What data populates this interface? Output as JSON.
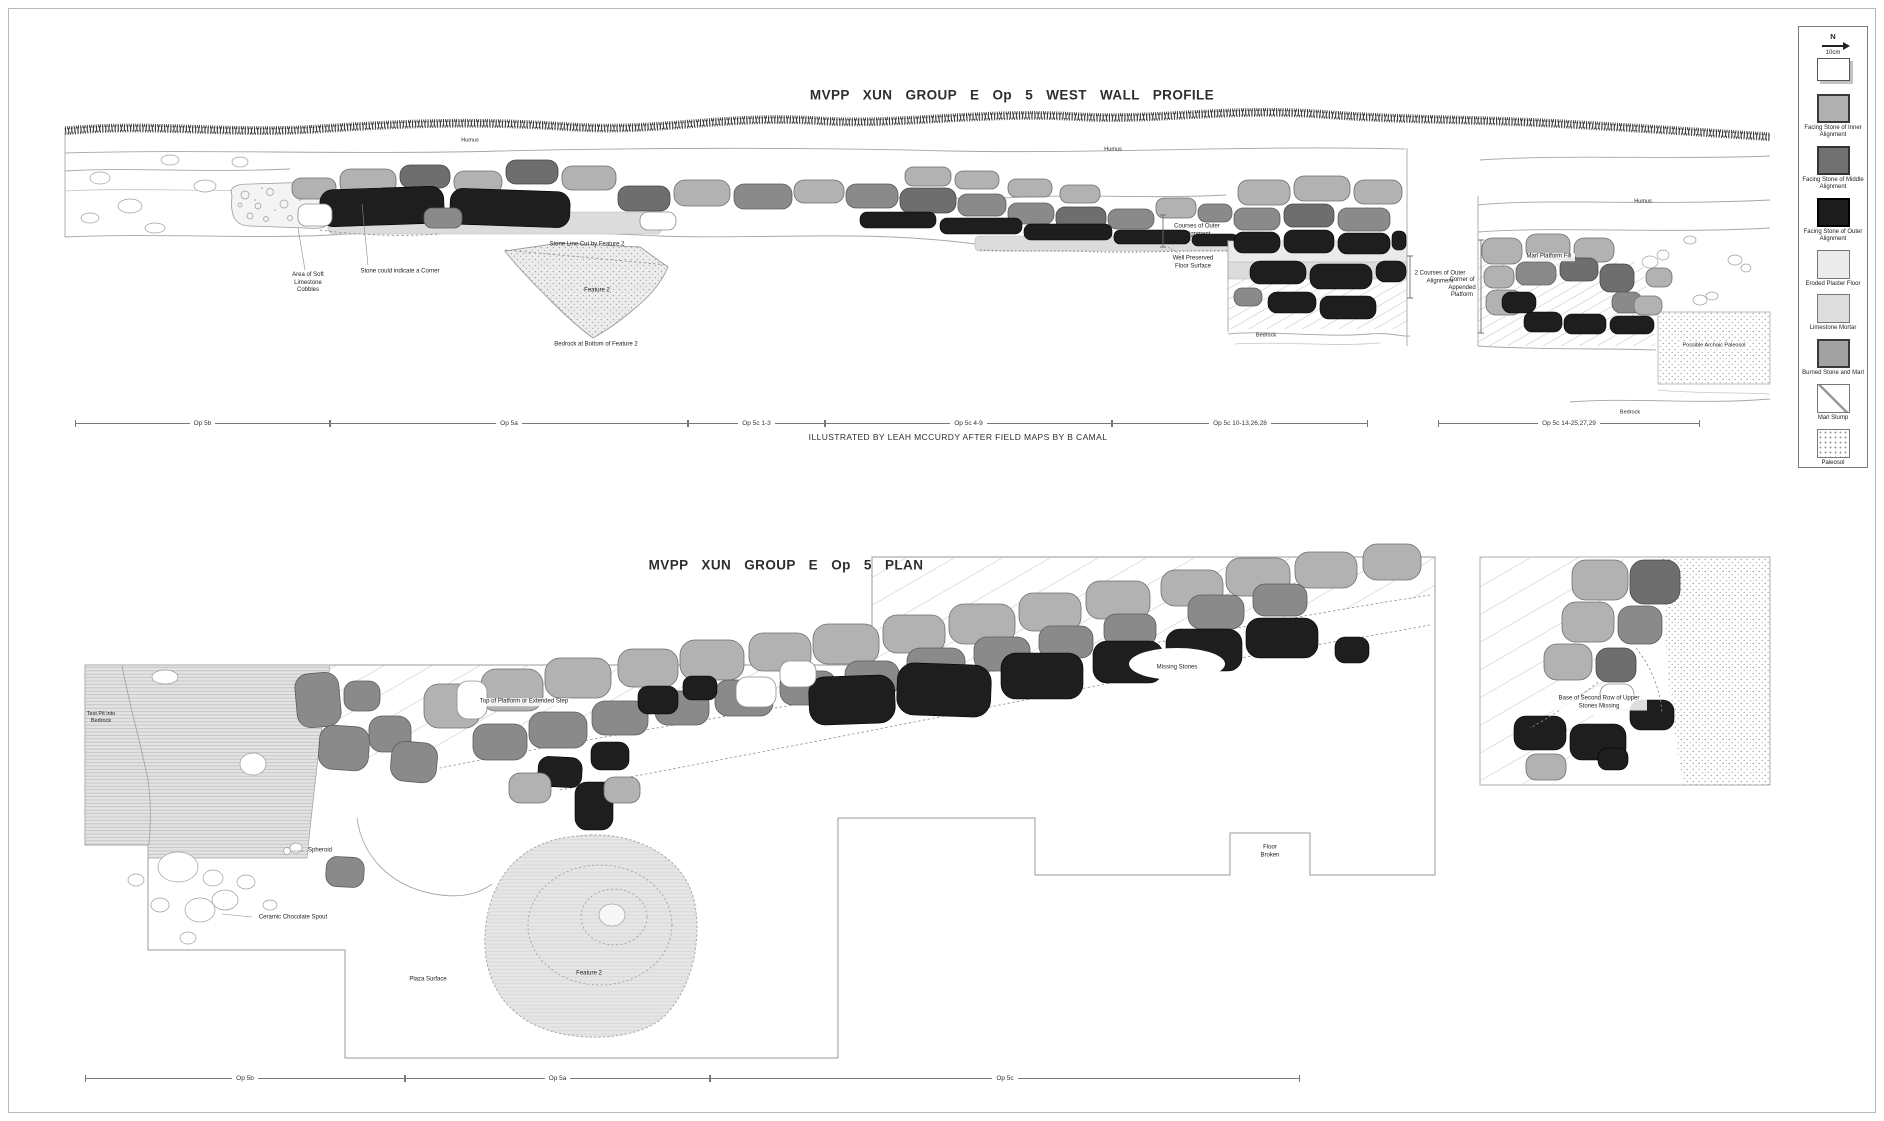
{
  "titles": {
    "profile": "MVPP XUN GROUP E Op 5 WEST WALL PROFILE",
    "plan": "MVPP XUN GROUP E Op 5 PLAN",
    "attribution": "ILLUSTRATED BY LEAH MCCURDY AFTER FIELD MAPS BY B CAMAL"
  },
  "legend": {
    "north_label": "N",
    "scale_label": "10cm",
    "items": [
      {
        "id": "inner",
        "label": "Facing Stone of Inner Alignment"
      },
      {
        "id": "middle",
        "label": "Facing Stone of Middle Alignment"
      },
      {
        "id": "outer",
        "label": "Facing Stone of Outer Alignment"
      },
      {
        "id": "plaster",
        "label": "Eroded Plaster Floor"
      },
      {
        "id": "mortar",
        "label": "Limestone Mortar"
      },
      {
        "id": "burned",
        "label": "Burned Stone and Marl"
      },
      {
        "id": "marl_slump",
        "label": "Marl Slump"
      },
      {
        "id": "paleosol",
        "label": "Paleosol"
      }
    ]
  },
  "profile": {
    "labels": {
      "humus_a": "Humus",
      "humus_b": "Humus",
      "humus_c": "Humus",
      "soft_cobbles": "Area of Soft Limestone Cobbles",
      "corner_stone": "Stone could indicate a Corner",
      "stone_line_cut": "Stone Line Cut by Feature 2",
      "feature_2": "Feature 2",
      "bedrock_feature_2": "Bedrock at Bottom of Feature 2",
      "floor_surface": "Well Preserved Floor Surface",
      "courses_outer": "Courses of Outer Alignment",
      "bedrock_platform": "Bedrock",
      "two_courses_outer": "2 Courses of Outer Alignment",
      "corner_appended": "Corner of Appended Platform",
      "marl_platform_fill": "Marl Platform Fill",
      "archaic_paleosol": "Possible Archaic Paleosol",
      "bedrock_right": "Bedrock"
    },
    "scale_segments": [
      "Op 5b",
      "Op 5a",
      "Op 5c 1-3",
      "Op 5c 4-9",
      "Op 5c 10-13,26,28",
      "Op 5c 14-25,27,29"
    ]
  },
  "plan": {
    "labels": {
      "test_pit": "Test Pit into Bedrock",
      "platform_top": "Top of Platform or Extended Step",
      "missing_stones": "Missing Stones",
      "spheroid": "Spheroid",
      "chocolate_spout": "Ceramic Chocolate Spout",
      "plaza_surface": "Plaza Surface",
      "feature_2": "Feature 2",
      "floor_broken": "Floor Broken",
      "inset_note": "Base of Second Row of Upper Stones Missing"
    },
    "scale_segments": [
      "Op 5b",
      "Op 5a",
      "Op 5c"
    ]
  },
  "colors": {
    "stone_light": "#b2b2b2",
    "stone_middle": "#8a8a8a",
    "stone_middle_dark": "#6e6e6e",
    "stone_dark": "#1e1e1e",
    "plaster_floor": "#ebebeb",
    "limestone_mortar": "#dddddd",
    "burned_marl": "#a2a2a2",
    "outline_gray": "#9a9a9a"
  }
}
